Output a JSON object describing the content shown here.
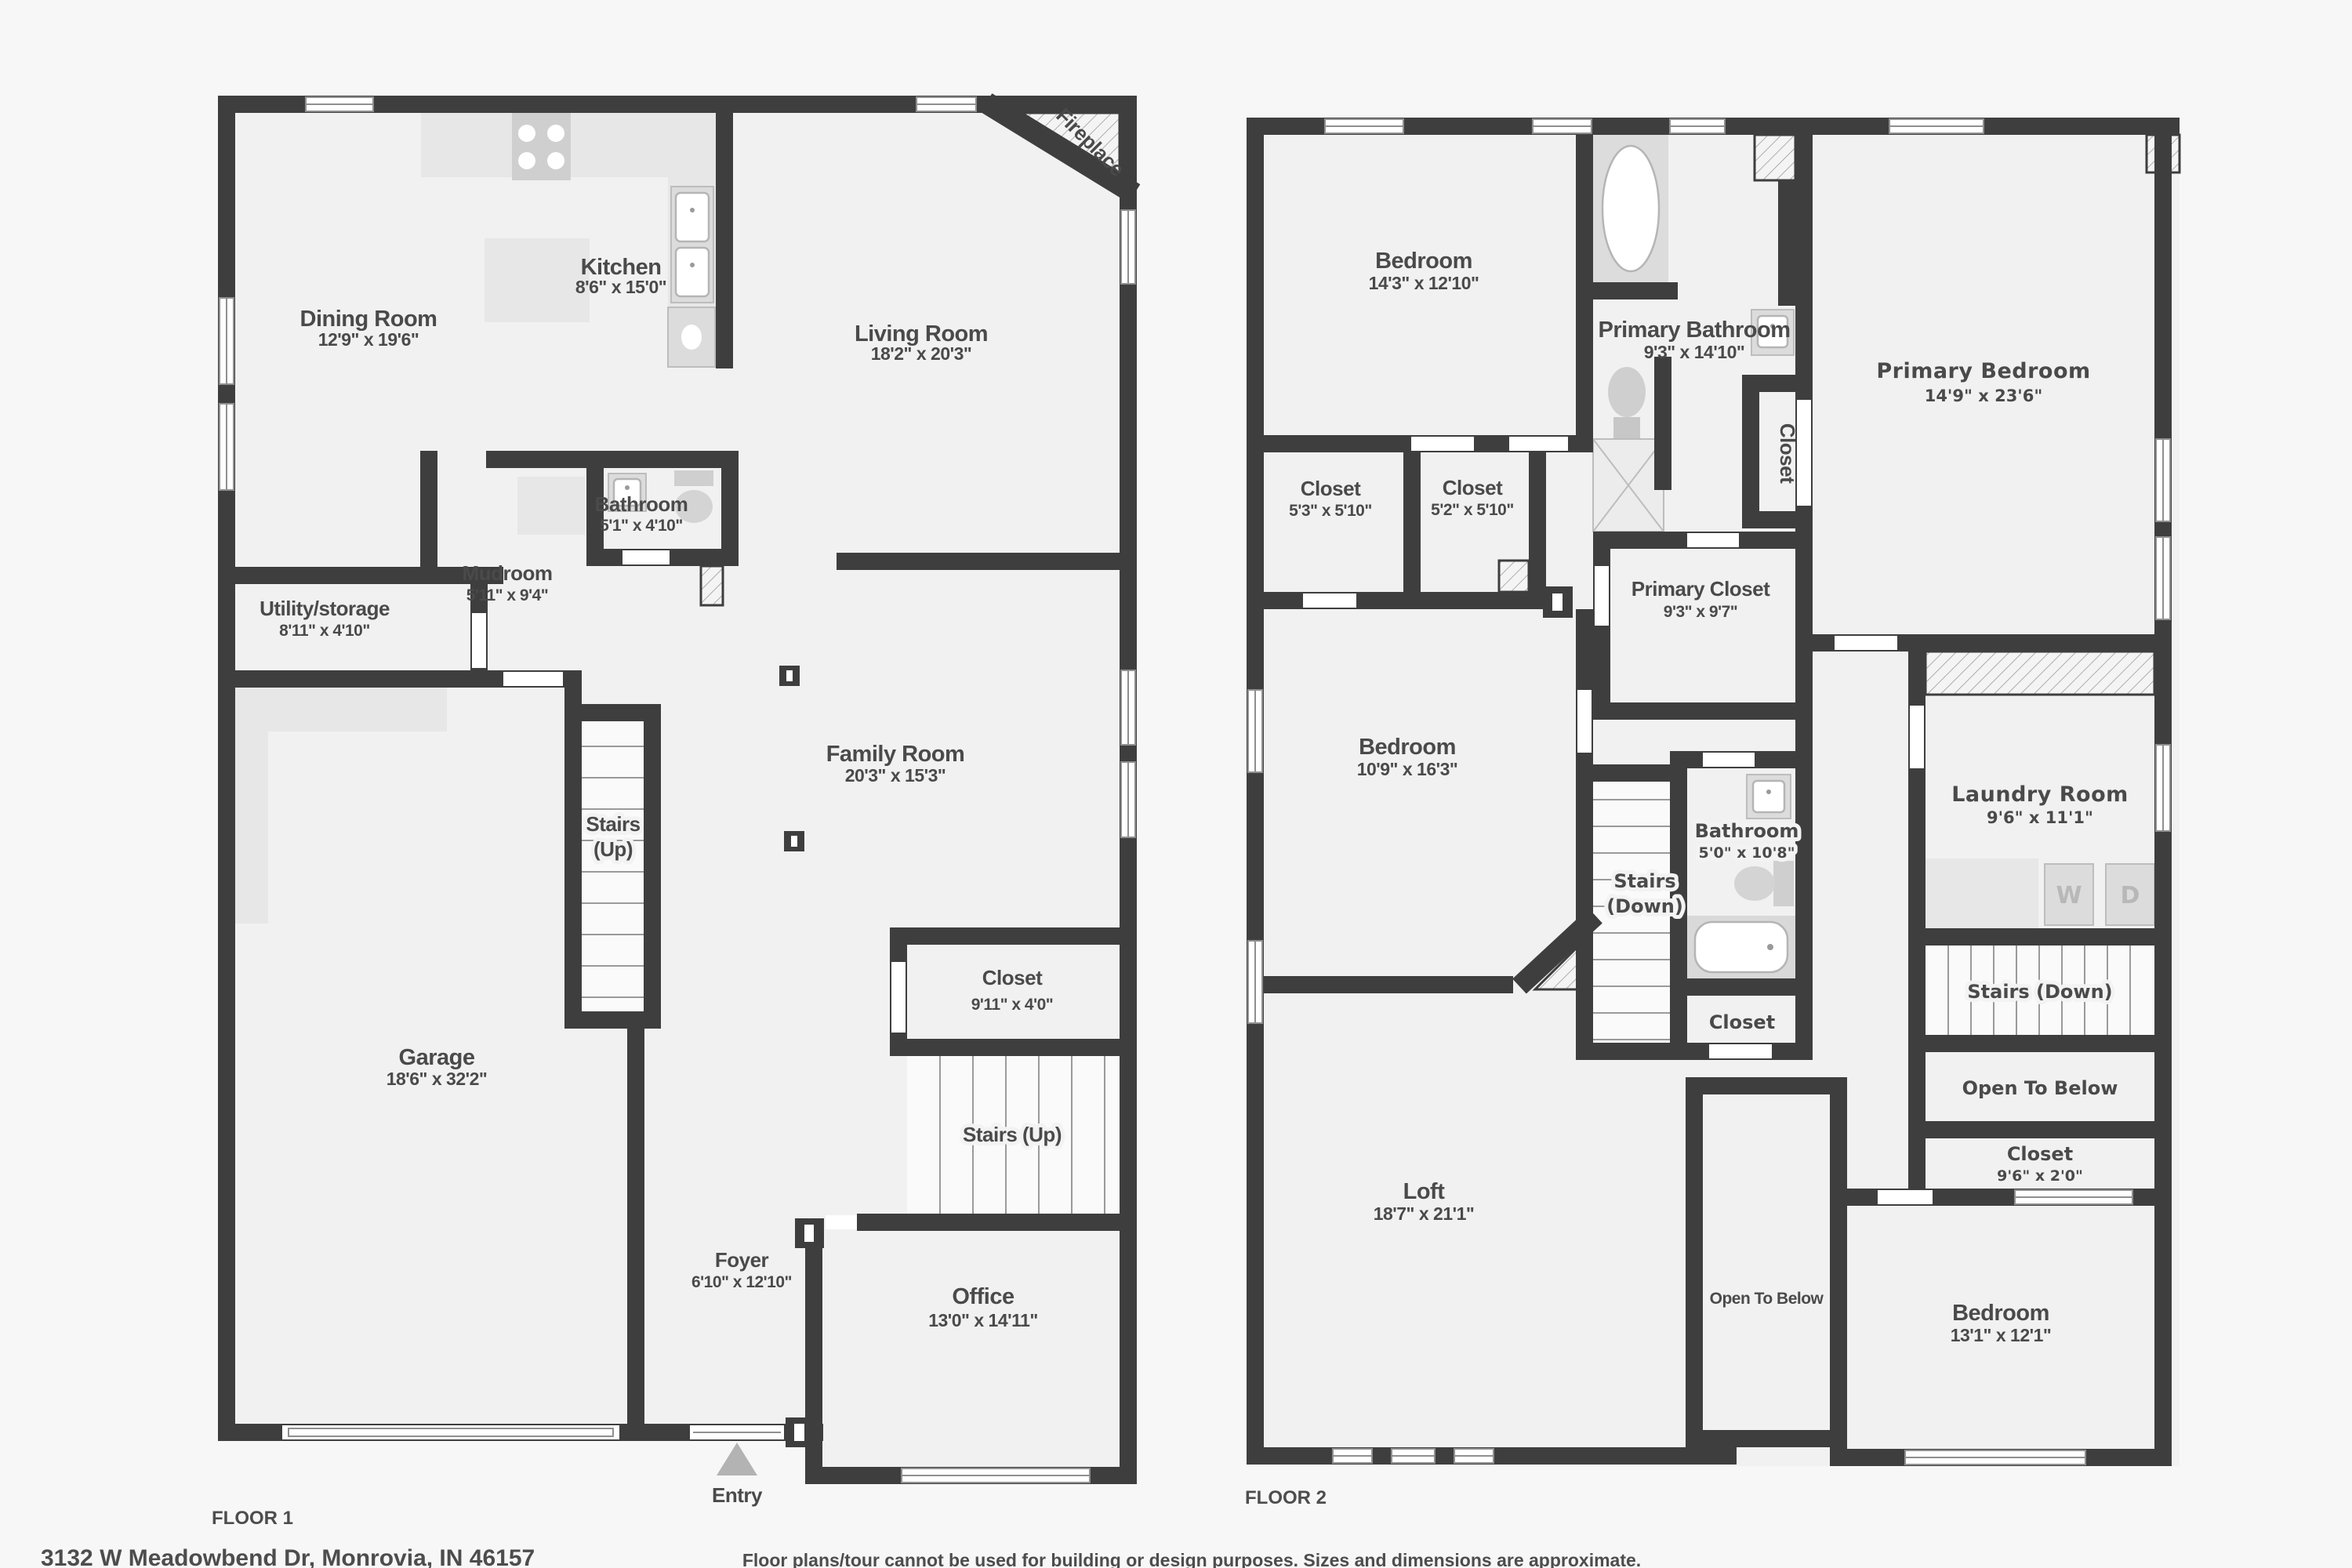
{
  "colors": {
    "wall": "#3e3e3e",
    "floor": "#f1f1f1",
    "background": "#f7f7f7",
    "text": "#4a4a4a",
    "arrow": "#b3b3b3"
  },
  "floor1": {
    "label": "FLOOR 1",
    "rooms": {
      "dining": {
        "name": "Dining Room",
        "dims": "12'9\" x 19'6\""
      },
      "kitchen": {
        "name": "Kitchen",
        "dims": "8'6\" x 15'0\""
      },
      "living": {
        "name": "Living Room",
        "dims": "18'2\" x 20'3\""
      },
      "fireplace": {
        "name": "Fireplace"
      },
      "bathroom": {
        "name": "Bathroom",
        "dims": "5'1\" x 4'10\""
      },
      "mudroom": {
        "name": "Mudroom",
        "dims": "5'11\" x 9'4\""
      },
      "utility": {
        "name": "Utility/storage",
        "dims": "8'11\" x 4'10\""
      },
      "stairs_left": {
        "line1": "Stairs",
        "line2": "(Up)"
      },
      "family": {
        "name": "Family Room",
        "dims": "20'3\" x 15'3\""
      },
      "garage": {
        "name": "Garage",
        "dims": "18'6\" x 32'2\""
      },
      "closet": {
        "name": "Closet",
        "dims": "9'11\" x 4'0\""
      },
      "stairs_right": {
        "name": "Stairs (Up)"
      },
      "foyer": {
        "name": "Foyer",
        "dims": "6'10\" x 12'10\""
      },
      "office": {
        "name": "Office",
        "dims": "13'0\" x 14'11\""
      },
      "entry": {
        "name": "Entry"
      }
    }
  },
  "floor2": {
    "label": "FLOOR 2",
    "rooms": {
      "bedroom1": {
        "name": "Bedroom",
        "dims": "14'3\" x 12'10\""
      },
      "primary_bathroom": {
        "name": "Primary Bathroom",
        "dims": "9'3\" x 14'10\""
      },
      "primary_bedroom": {
        "name": "Primary Bedroom",
        "dims": "14'9\" x 23'6\""
      },
      "closet1": {
        "name": "Closet",
        "dims": "5'3\" x 5'10\""
      },
      "closet2": {
        "name": "Closet",
        "dims": "5'2\" x 5'10\""
      },
      "closet_vertical": {
        "name": "Closet"
      },
      "primary_closet": {
        "name": "Primary Closet",
        "dims": "9'3\" x 9'7\""
      },
      "bedroom2": {
        "name": "Bedroom",
        "dims": "10'9\" x 16'3\""
      },
      "bathroom": {
        "name": "Bathroom",
        "dims": "5'0\" x 10'8\""
      },
      "stairs_left": {
        "line1": "Stairs",
        "line2": "(Down)"
      },
      "closet_mid": {
        "name": "Closet"
      },
      "laundry": {
        "name": "Laundry Room",
        "dims": "9'6\" x 11'1\""
      },
      "washer": {
        "label": "W"
      },
      "dryer": {
        "label": "D"
      },
      "stairs_right": {
        "name": "Stairs (Down)"
      },
      "open_below_right": {
        "name": "Open To Below"
      },
      "closet_small": {
        "name": "Closet",
        "dims": "9'6\" x 2'0\""
      },
      "loft": {
        "name": "Loft",
        "dims": "18'7\" x 21'1\""
      },
      "open_below_mid": {
        "name": "Open To Below"
      },
      "bedroom3": {
        "name": "Bedroom",
        "dims": "13'1\" x 12'1\""
      }
    }
  },
  "footer": {
    "address": "3132 W Meadowbend Dr, Monrovia, IN 46157",
    "disclaimer": "Floor plans/tour cannot be used for building or design purposes. Sizes and dimensions are approximate."
  }
}
